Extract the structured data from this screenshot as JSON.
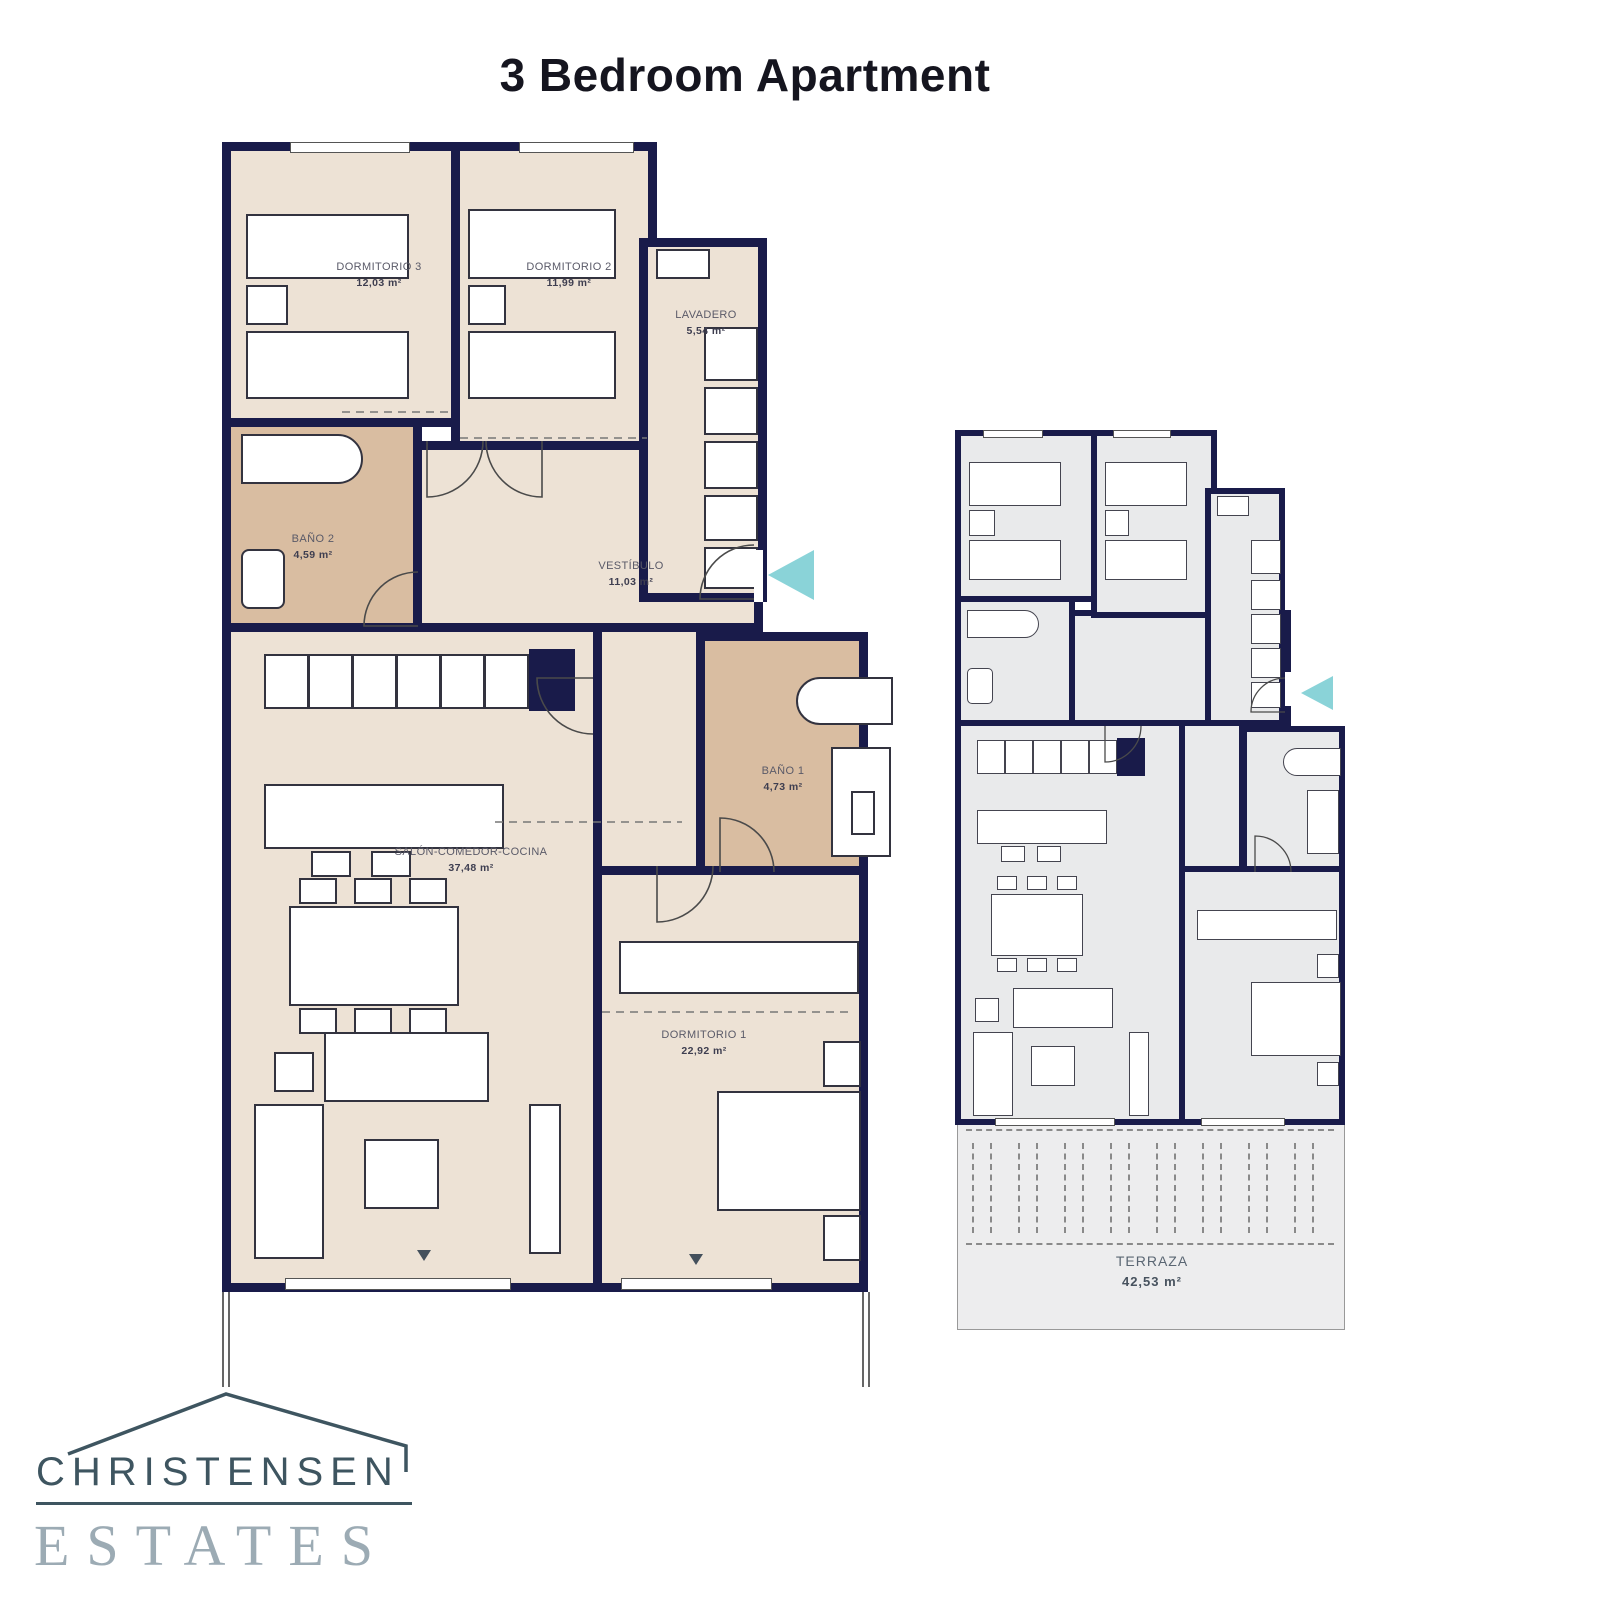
{
  "title": "3 Bedroom Apartment",
  "main_plan": {
    "rooms": [
      {
        "id": "dormitorio-3",
        "name": "DORMITORIO 3",
        "area": "12,03 m²"
      },
      {
        "id": "dormitorio-2",
        "name": "DORMITORIO 2",
        "area": "11,99 m²"
      },
      {
        "id": "lavadero",
        "name": "LAVADERO",
        "area": "5,54 m²"
      },
      {
        "id": "bano-2",
        "name": "BAÑO 2",
        "area": "4,59 m²"
      },
      {
        "id": "vestibulo",
        "name": "VESTÍBULO",
        "area": "11,03 m²"
      },
      {
        "id": "salon-comedor-cocina",
        "name": "SALÓN-COMEDOR-COCINA",
        "area": "37,48 m²"
      },
      {
        "id": "bano-1",
        "name": "BAÑO 1",
        "area": "4,73 m²"
      },
      {
        "id": "dormitorio-1",
        "name": "DORMITORIO 1",
        "area": "22,92 m²"
      }
    ]
  },
  "mini_plan": {
    "rooms": [
      {
        "id": "terraza",
        "name": "TERRAZA",
        "area": "42,53 m²"
      }
    ]
  },
  "logo": {
    "name": "CHRISTENSEN",
    "type": "ESTATES"
  },
  "colors": {
    "wall": "#191b4a",
    "floor": "#ede2d5",
    "bathroom_floor": "#d9bda1",
    "mini_floor": "#e9eaeb",
    "entrance_arrow": "#8ad3d8",
    "logo_dark": "#3e5560",
    "logo_light": "#9cabb4",
    "title_text": "#15151f"
  }
}
